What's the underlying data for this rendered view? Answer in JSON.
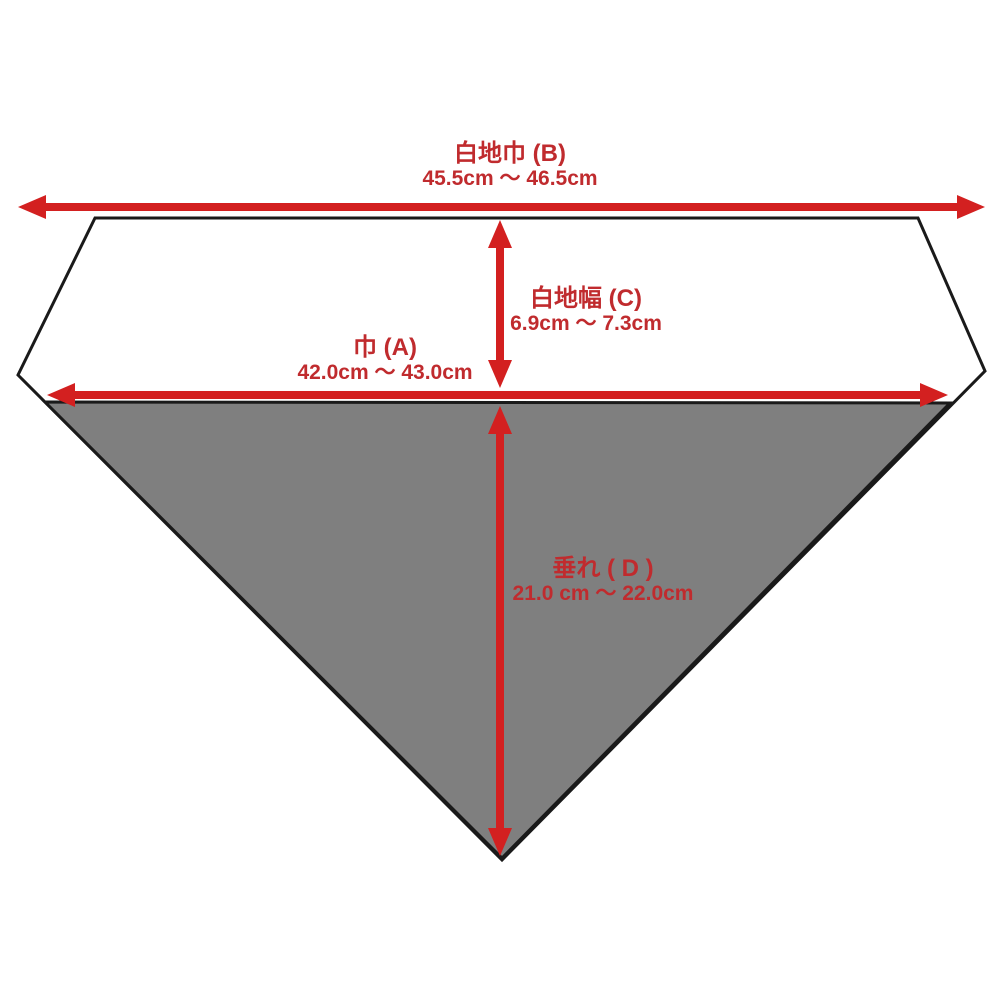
{
  "diagram": {
    "subject": "bandana-dimension-diagram",
    "dimensions": [
      {
        "id": "B",
        "name": "白地巾 (B)",
        "range": "45.5cm ～ 46.5cm",
        "orientation": "horizontal",
        "measures": "full top width"
      },
      {
        "id": "C",
        "name": "白地幅 (C)",
        "range": "6.9cm ～ 7.3cm",
        "orientation": "vertical",
        "measures": "white band height"
      },
      {
        "id": "A",
        "name": "巾 (A)",
        "range": "42.0cm ～ 43.0cm",
        "orientation": "horizontal",
        "measures": "width at fold line"
      },
      {
        "id": "D",
        "name": "垂れ ( D )",
        "range": "21.0 cm ～ 22.0cm",
        "orientation": "vertical",
        "measures": "hanging flap length"
      }
    ]
  },
  "colors": {
    "arrow_red": "#d32020",
    "text_red": "#c02b2e",
    "flap_gray": "#7f7f7f",
    "outline_black": "#1a1a1a",
    "background": "#ffffff"
  }
}
